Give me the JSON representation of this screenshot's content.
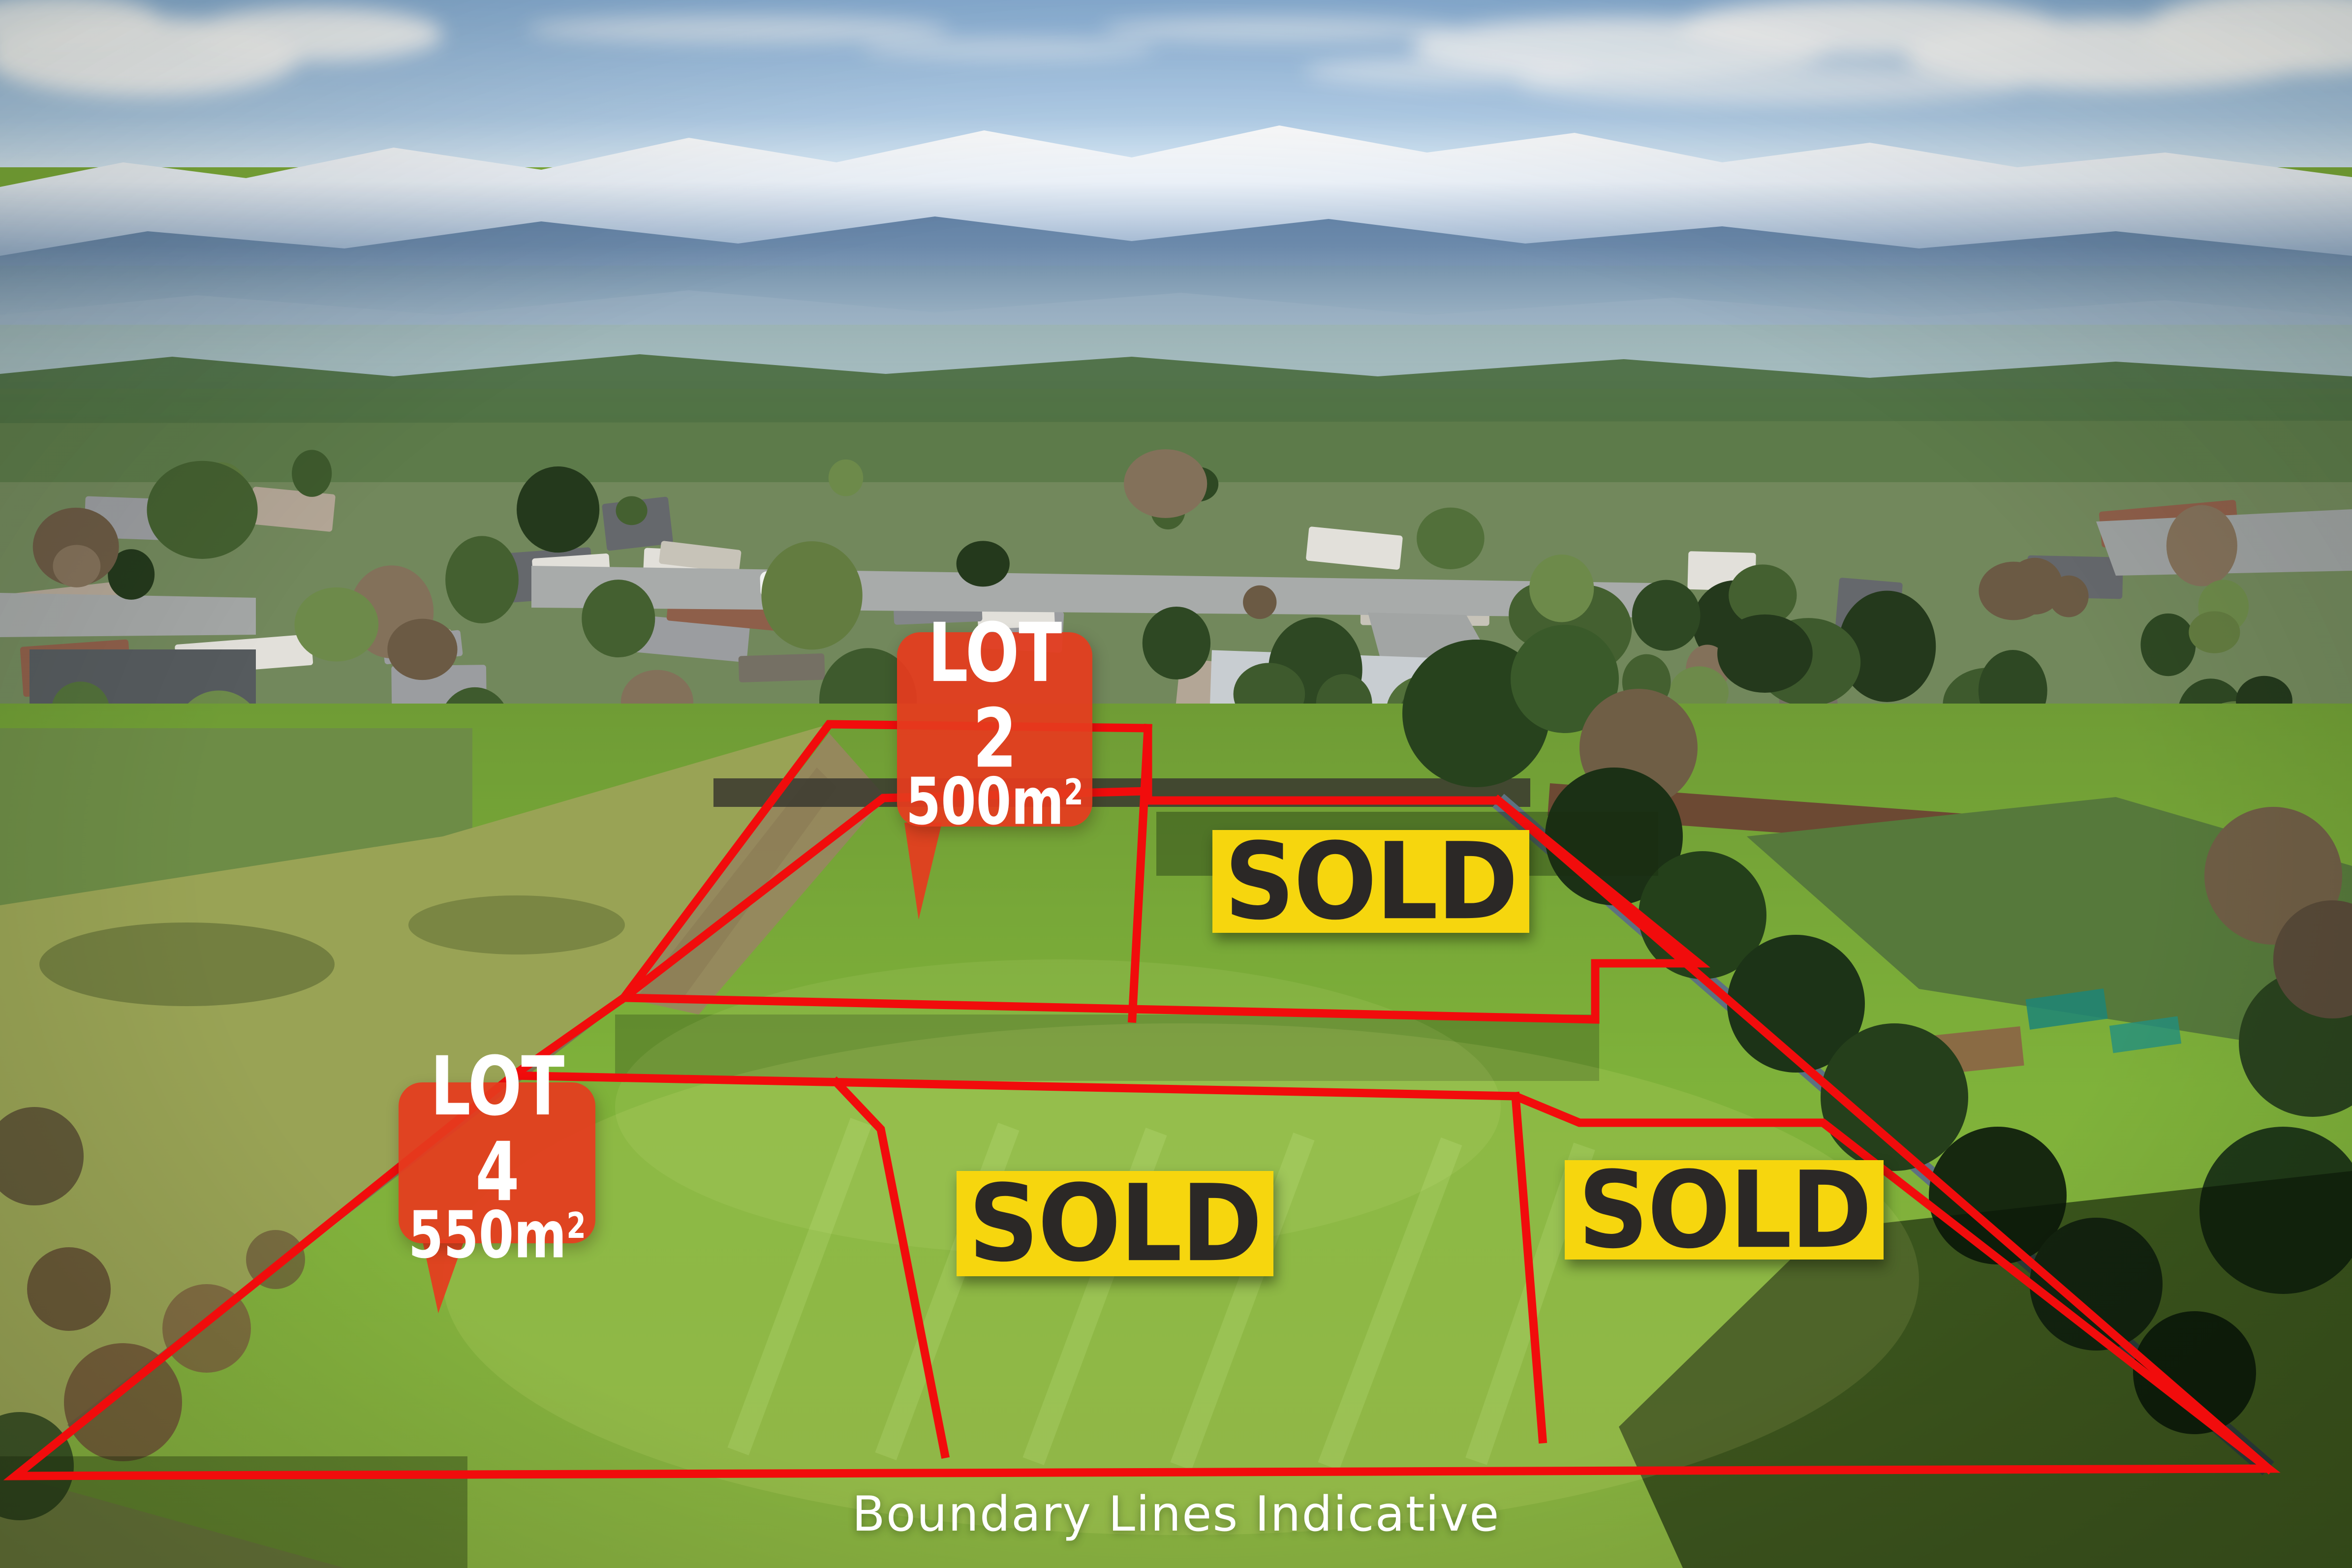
{
  "scene": {
    "caption": "Boundary Lines Indicative",
    "description": "aerial-photo-of-subdivision-lots"
  },
  "lot_tags": [
    {
      "name": "LOT 2",
      "area": "500m",
      "area_sup": "2"
    },
    {
      "name": "LOT 4",
      "area": "550m",
      "area_sup": "2"
    }
  ],
  "sold_badges": [
    {
      "label": "SOLD"
    },
    {
      "label": "SOLD"
    },
    {
      "label": "SOLD"
    }
  ],
  "colors": {
    "tag_red": "#e53b1e",
    "boundary_red": "#f10c0c",
    "badge_yellow": "#f6d60e",
    "badge_text": "#2b2826",
    "caption_white": "#ffffff",
    "sky_blue": "#9fc2e4",
    "grass_green": "#7fae3a"
  },
  "boundaries": {
    "upper_polygon": "1685,1472 2333,1480 2333,1627 3045,1627 3452,1958 3242,1958 3242,2072 1268,2028",
    "lower_polygon": "1043,2186 3080,2228 3210,2282 3705,2282 4610,2985 31,3000",
    "left_diagonal_extension": "1043,2186 1268,2028",
    "fence_diagonal": "3045,1627 4610,2985",
    "lot2_left_edge": "1268,2028 1795,1622 2331,1608",
    "lot2_divider": "2333,1480 2301,2070",
    "lot4_divider": "1700,2200 1790,2295 1920,2955",
    "sold_divider": "3080,2228 3135,2925"
  }
}
